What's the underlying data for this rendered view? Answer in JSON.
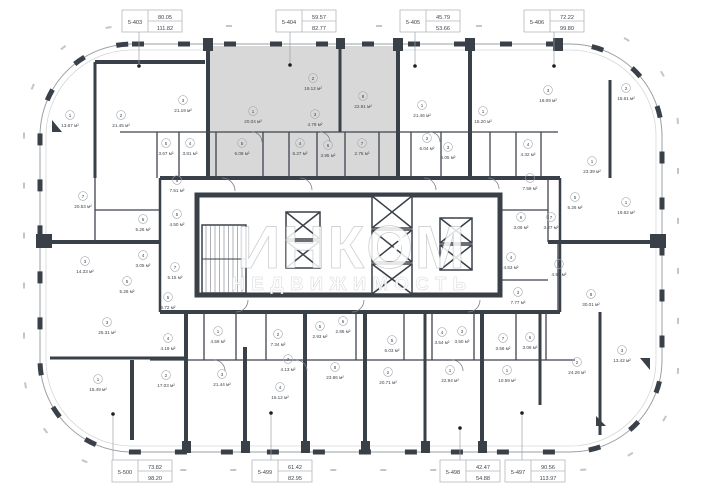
{
  "watermark": {
    "title": "ИНКОМ",
    "subtitle": "НЕДВИЖИМОСТЬ"
  },
  "callouts": {
    "top": [
      {
        "id": "5-403",
        "value_top": "80.05",
        "value_bottom": "111.82",
        "x": 152,
        "dot_x": 139,
        "dot_y": 66
      },
      {
        "id": "5-404",
        "value_top": "59.57",
        "value_bottom": "82.77",
        "x": 306,
        "dot_x": 290,
        "dot_y": 65
      },
      {
        "id": "5-405",
        "value_top": "45.79",
        "value_bottom": "53.66",
        "x": 430,
        "dot_x": 415,
        "dot_y": 66
      },
      {
        "id": "5-406",
        "value_top": "72.22",
        "value_bottom": "99.80",
        "x": 554,
        "dot_x": 554,
        "dot_y": 66
      }
    ],
    "bottom": [
      {
        "id": "5-500",
        "value_top": "73.82",
        "value_bottom": "98.20",
        "x": 142,
        "dot_x": 113,
        "dot_y": 414
      },
      {
        "id": "5-499",
        "value_top": "61.42",
        "value_bottom": "82.95",
        "x": 282,
        "dot_x": 271,
        "dot_y": 413
      },
      {
        "id": "5-498",
        "value_top": "42.47",
        "value_bottom": "54.88",
        "x": 470,
        "dot_x": 460,
        "dot_y": 428
      },
      {
        "id": "5-497",
        "value_top": "90.56",
        "value_bottom": "113.97",
        "x": 535,
        "dot_x": 522,
        "dot_y": 413
      }
    ]
  },
  "rooms": [
    {
      "n": "1",
      "a": "13.67 м²",
      "x": 70,
      "y": 122
    },
    {
      "n": "2",
      "a": "21.45 м²",
      "x": 121,
      "y": 122
    },
    {
      "n": "3",
      "a": "21.19 м²",
      "x": 183,
      "y": 107
    },
    {
      "n": "5",
      "a": "3.67 м²",
      "x": 166,
      "y": 150
    },
    {
      "n": "4",
      "a": "3.81 м²",
      "x": 190,
      "y": 150
    },
    {
      "n": "1",
      "a": "20.04 м²",
      "x": 253,
      "y": 118
    },
    {
      "n": "2",
      "a": "19.12 м²",
      "x": 313,
      "y": 85
    },
    {
      "n": "3",
      "a": "4.79 м²",
      "x": 315,
      "y": 121
    },
    {
      "n": "8",
      "a": "22.91 м²",
      "x": 363,
      "y": 103
    },
    {
      "n": "5",
      "a": "6.08 м²",
      "x": 242,
      "y": 150
    },
    {
      "n": "4",
      "a": "6.27 м²",
      "x": 300,
      "y": 150
    },
    {
      "n": "6",
      "a": "3.95 м²",
      "x": 328,
      "y": 152
    },
    {
      "n": "7",
      "a": "2.75 м²",
      "x": 362,
      "y": 150
    },
    {
      "n": "1",
      "a": "21.46 м²",
      "x": 422,
      "y": 112
    },
    {
      "n": "2",
      "a": "6.04 м²",
      "x": 427,
      "y": 145
    },
    {
      "n": "3",
      "a": "6.05 м²",
      "x": 448,
      "y": 154
    },
    {
      "n": "1",
      "a": "15.20 м²",
      "x": 483,
      "y": 118
    },
    {
      "n": "4",
      "a": "4.32 м²",
      "x": 528,
      "y": 151
    },
    {
      "n": "3",
      "a": "18.09 м²",
      "x": 548,
      "y": 97
    },
    {
      "n": "2",
      "a": "15.61 м²",
      "x": 626,
      "y": 95
    },
    {
      "n": "1",
      "a": "23.39 м²",
      "x": 592,
      "y": 168
    },
    {
      "n": "7",
      "a": "20.53 м²",
      "x": 83,
      "y": 203
    },
    {
      "n": "5",
      "a": "7.51 м²",
      "x": 177,
      "y": 187
    },
    {
      "n": "6",
      "a": "5.26 м²",
      "x": 143,
      "y": 226
    },
    {
      "n": "5",
      "a": "4.50 м²",
      "x": 177,
      "y": 221
    },
    {
      "n": "3",
      "a": "14.33 м²",
      "x": 85,
      "y": 268
    },
    {
      "n": "4",
      "a": "3.05 м²",
      "x": 143,
      "y": 262
    },
    {
      "n": "7",
      "a": "5.15 м²",
      "x": 175,
      "y": 274
    },
    {
      "n": "5",
      "a": "5.28 м²",
      "x": 127,
      "y": 288
    },
    {
      "n": "3",
      "a": "7.59 м²",
      "x": 530,
      "y": 185
    },
    {
      "n": "5",
      "a": "5.26 м²",
      "x": 575,
      "y": 204
    },
    {
      "n": "1",
      "a": "19.62 м²",
      "x": 626,
      "y": 209
    },
    {
      "n": "6",
      "a": "3.06 м²",
      "x": 521,
      "y": 224
    },
    {
      "n": "7",
      "a": "3.27 м²",
      "x": 551,
      "y": 224
    },
    {
      "n": "4",
      "a": "4.53 м²",
      "x": 511,
      "y": 264
    },
    {
      "n": "5",
      "a": "4.53 м²",
      "x": 559,
      "y": 271
    },
    {
      "n": "3",
      "a": "7.77 м²",
      "x": 518,
      "y": 299
    },
    {
      "n": "8",
      "a": "30.01 м²",
      "x": 591,
      "y": 301
    },
    {
      "n": "5",
      "a": "6.72 м²",
      "x": 168,
      "y": 304
    },
    {
      "n": "4",
      "a": "4.19 м²",
      "x": 168,
      "y": 345
    },
    {
      "n": "3",
      "a": "25.31 м²",
      "x": 107,
      "y": 329
    },
    {
      "n": "1",
      "a": "15.49 м²",
      "x": 98,
      "y": 386
    },
    {
      "n": "2",
      "a": "17.03 м²",
      "x": 166,
      "y": 382
    },
    {
      "n": "1",
      "a": "4.59 м²",
      "x": 218,
      "y": 338
    },
    {
      "n": "3",
      "a": "21.44 м²",
      "x": 222,
      "y": 381
    },
    {
      "n": "2",
      "a": "7.34 м²",
      "x": 278,
      "y": 341
    },
    {
      "n": "7",
      "a": "4.13 м²",
      "x": 288,
      "y": 366
    },
    {
      "n": "4",
      "a": "16.12 м²",
      "x": 280,
      "y": 394
    },
    {
      "n": "5",
      "a": "2.93 м²",
      "x": 320,
      "y": 333
    },
    {
      "n": "6",
      "a": "2.86 м²",
      "x": 343,
      "y": 328
    },
    {
      "n": "8",
      "a": "23.86 м²",
      "x": 335,
      "y": 374
    },
    {
      "n": "5",
      "a": "6.03 м²",
      "x": 392,
      "y": 347
    },
    {
      "n": "2",
      "a": "20.71 м²",
      "x": 388,
      "y": 379
    },
    {
      "n": "4",
      "a": "3.54 м²",
      "x": 442,
      "y": 339
    },
    {
      "n": "3",
      "a": "3.50 м²",
      "x": 462,
      "y": 338
    },
    {
      "n": "7",
      "a": "3.56 м²",
      "x": 503,
      "y": 345
    },
    {
      "n": "6",
      "a": "3.06 м²",
      "x": 530,
      "y": 344
    },
    {
      "n": "1",
      "a": "22.94 м²",
      "x": 450,
      "y": 377
    },
    {
      "n": "1",
      "a": "10.59 м²",
      "x": 507,
      "y": 377
    },
    {
      "n": "2",
      "a": "24.26 м²",
      "x": 577,
      "y": 369
    },
    {
      "n": "3",
      "a": "13.42 м²",
      "x": 622,
      "y": 357
    }
  ]
}
